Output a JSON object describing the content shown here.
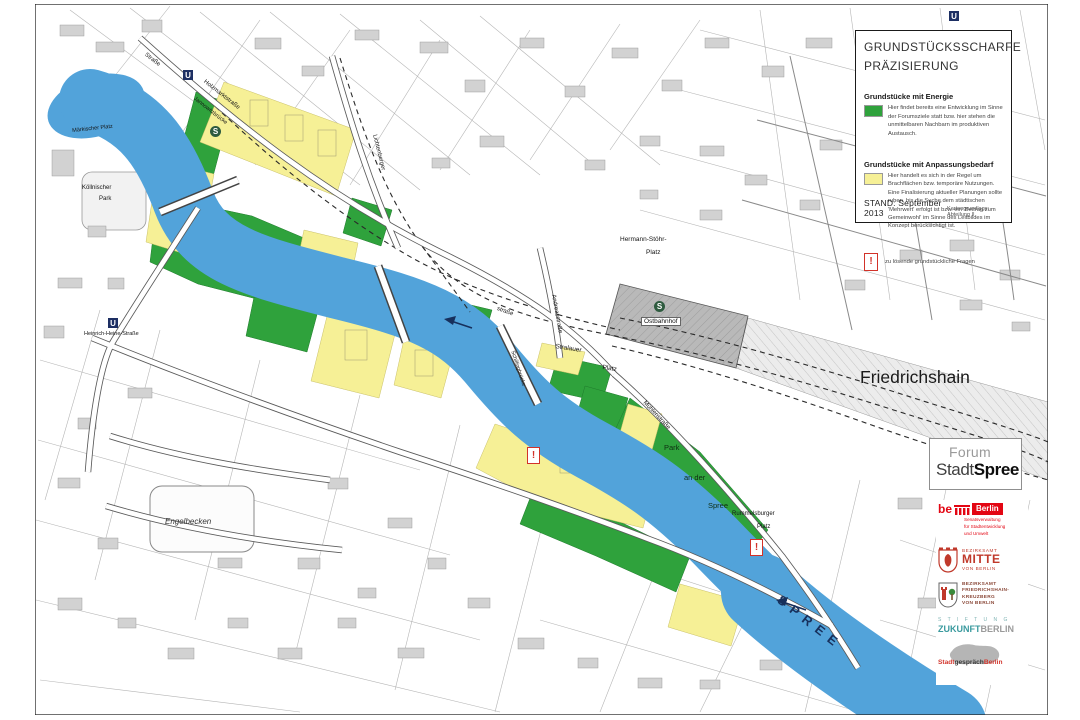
{
  "legend": {
    "title_line1": "GRUNDSTÜCKSSCHARFE",
    "title_line2": "PRÄZISIERUNG",
    "entries": [
      {
        "heading": "Grundstücke mit Energie",
        "swatch_color": "#2fa23c",
        "description": "Hier findet bereits eine Entwicklung im Sinne der Forumsziele statt bzw. hier stehen die unmittelbaren Nachbarn im produktiven Austausch."
      },
      {
        "heading": "Grundstücke mit Anpassungsbedarf",
        "swatch_color": "#f6f096",
        "description": "Hier handelt es sich in der Regel um Brachflächen bzw. temporäre Nutzungen. Eine Finalisierung aktueller Planungen sollte ruhen, bis die Suche dem städtischen 'Mehrwert' erfolgt ist bzw. ein 'Beitrag zum Gemeinwohl' im Sinne des Leitbildes im Konzept berücksichtigt ist."
      }
    ],
    "exclamation_note": "zu lösende grundstückliche Fragen",
    "stand": "STAND: September 2013",
    "source": "Kartengrundlage: Abteilung II"
  },
  "forum_box": {
    "line1": "Forum",
    "stadt": "Stadt",
    "spree": "Spree"
  },
  "logos": {
    "senate": {
      "be": "be",
      "berlin": "Berlin",
      "sub1": "Senatsverwaltung",
      "sub2": "für Stadtentwicklung",
      "sub3": "und Umwelt"
    },
    "mitte": {
      "l1": "BEZIRKSAMT",
      "l2": "MITTE",
      "l3": "VON BERLIN"
    },
    "friedrichshain_kreuzberg": {
      "l1": "BEZIRKSAMT",
      "l2": "FRIEDRICHSHAIN-",
      "l3": "KREUZBERG",
      "l4": "VON BERLIN"
    },
    "stiftung": {
      "l1": "S T I F T U N G",
      "l2a": "ZUKUNFT",
      "l2b": "BERLIN"
    },
    "stadtgespraech": {
      "a": "Stadt",
      "b": "gespräch",
      "c": "Berlin"
    }
  },
  "map": {
    "icons": {
      "ubahn": "U",
      "sbahn": "S",
      "exclamation": "!"
    },
    "colors": {
      "river": "#52a3da",
      "energy_green": "#2fa23c",
      "adaptation_yellow": "#f6f096",
      "alert_red": "#d23229",
      "station_gray": "#b9b9b9",
      "spree_label": "#17305c"
    },
    "labels": [
      {
        "text": "Friedrichshain"
      },
      {
        "text": "SPREE"
      },
      {
        "text": "Engelbecken"
      },
      {
        "text": "Ostbahnhof"
      },
      {
        "text": "Hermann-Stöhr-"
      },
      {
        "text": "Platz"
      },
      {
        "text": "Stralauer"
      },
      {
        "text": "Platz"
      },
      {
        "text": "Rummelsburger"
      },
      {
        "text": "Platz"
      },
      {
        "text": "Park"
      },
      {
        "text": "an der"
      },
      {
        "text": "Spree"
      },
      {
        "text": "Heinrich-Heine-Straße"
      },
      {
        "text": "Jannowitzbrücke"
      },
      {
        "text": "Holzmarktstraße"
      },
      {
        "text": "Straße"
      },
      {
        "text": "Köllnischer"
      },
      {
        "text": "Park"
      },
      {
        "text": "Märkischer Platz"
      },
      {
        "text": "Andreasstraße"
      },
      {
        "text": "Schillingbrücke"
      },
      {
        "text": "Mühlenstraße"
      },
      {
        "text": "Lichtenberger"
      },
      {
        "text": "straße"
      }
    ]
  }
}
